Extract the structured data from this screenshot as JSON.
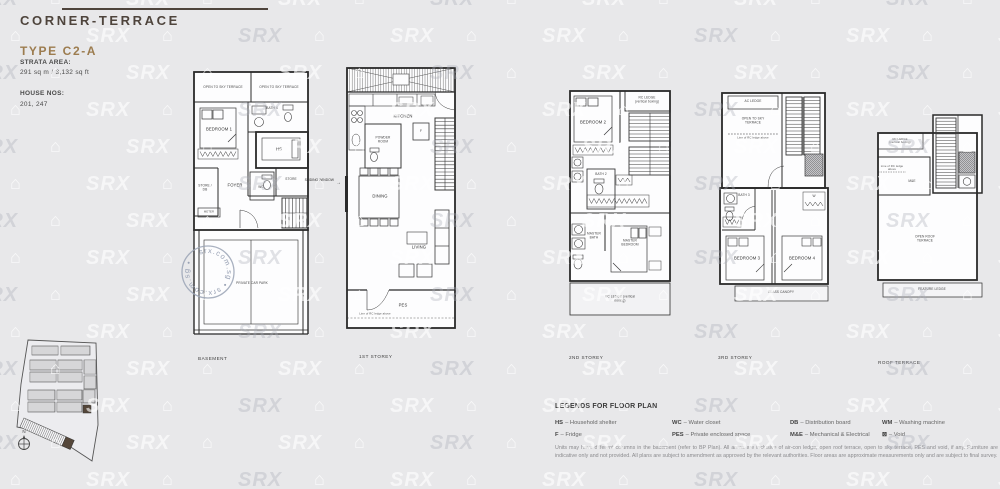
{
  "header": {
    "category": "CORNER-TERRACE",
    "unit_type": "TYPE C2-A",
    "strata_area_label": "STRATA AREA:",
    "strata_area_value": "291 sq m / 3,132 sq ft",
    "house_nos_label": "HOUSE NOS:",
    "house_nos_value": "201, 247"
  },
  "watermark": {
    "brand": "SRX",
    "house_icon": "⌂",
    "stamp_text": "srx.com.sg • srx.com.sg •"
  },
  "plans": {
    "basement": {
      "floor_label": "BASEMENT",
      "open_terrace_left": "OPEN TO SKY TERRACE",
      "open_terrace_right": "OPEN TO SKY TERRACE",
      "bedroom1": "BEDROOM 1",
      "bath4": "BATH 4",
      "hs": "HS",
      "store": "STORE",
      "store_db": "STORE / DB",
      "foyer": "FOYER",
      "wc": "WC",
      "meter": "METER",
      "car_park": "PRIVATE CAR PARK"
    },
    "first": {
      "floor_label": "1ST STOREY",
      "kitchen": "KITCHEN",
      "powder_room": "POWDER ROOM",
      "fridge": "F",
      "dining": "DINING",
      "living": "LIVING",
      "pes": "PES",
      "rc_ledge_note": "Line of RC ledge above",
      "sliding_window": "SLIDING WINDOW",
      "arrow": "→"
    },
    "second": {
      "floor_label": "2ND STOREY",
      "bedroom2": "BEDROOM 2",
      "rc_ledge_top": "RC LEDGE (vertical boxing)",
      "bath2": "BATH 2",
      "master_bath": "MASTER BATH",
      "master_bedroom": "MASTER BEDROOM",
      "rc_ledge_bottom": "RC LEDGE (vertical boxing)"
    },
    "third": {
      "floor_label": "3RD STOREY",
      "ac_ledge": "AC LEDGE",
      "open_terrace": "OPEN TO SKY TERRACE",
      "rc_ledge_note": "Line of RC ledge above",
      "bath3": "BATH 3",
      "wardrobe": "W",
      "bedroom3": "BEDROOM 3",
      "bedroom4": "BEDROOM 4",
      "glass_canopy": "GLASS CANOPY"
    },
    "roof": {
      "floor_label": "ROOF TERRACE",
      "rc_ledge": "RC LEDGE (vertical boxing)",
      "rc_ledge_note": "Line of RC ledge above",
      "me": "M&E",
      "open_roof_terrace": "OPEN ROOF TERRACE",
      "feature_ledge": "FEATURE LEDGE"
    }
  },
  "site_plan": {
    "north_label": "N"
  },
  "legend": {
    "title": "LEGENDS FOR FLOOR PLAN",
    "items": [
      {
        "abbr": "HS",
        "desc": "– Household shelter"
      },
      {
        "abbr": "F",
        "desc": "– Fridge"
      },
      {
        "abbr": "WC",
        "desc": "– Water closet"
      },
      {
        "abbr": "PES",
        "desc": "– Private enclosed space"
      },
      {
        "abbr": "DB",
        "desc": "– Distribution board"
      },
      {
        "abbr": "M&E",
        "desc": "– Mechanical & Electrical"
      },
      {
        "abbr": "WM",
        "desc": "– Washing machine"
      },
      {
        "abbr": "⊠",
        "desc": "– Void"
      }
    ],
    "disclaimer": "Units may have different columns in the basement (refer to BP Plan). All areas are inclusive of air-con ledge, open roof terrace, open to sky terrace, PES and void, if any. Furniture are indicative only and not provided. All plans are subject to amendment as approved by the relevant authorities. Floor areas are approximate measurements only and are subject to final survey."
  }
}
